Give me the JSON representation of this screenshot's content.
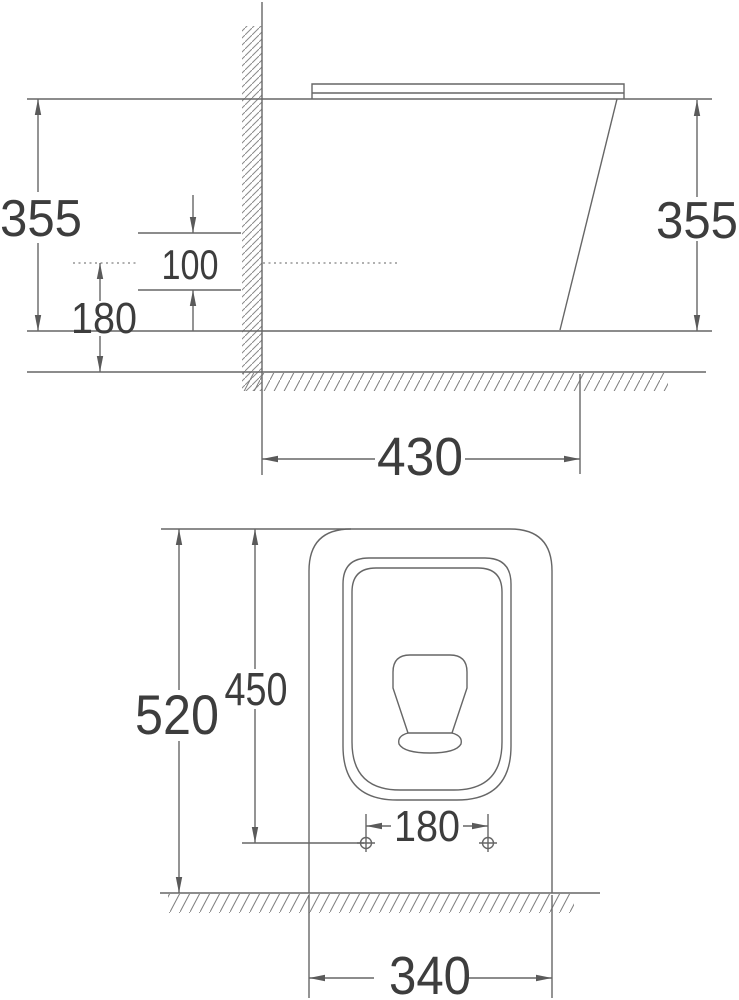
{
  "colors": {
    "background": "#ffffff",
    "line": "#666666",
    "hatch": "#8a8a8a",
    "text": "#3d3d3d"
  },
  "side_view": {
    "description": "side elevation of wall-adjacent toilet with wall and floor hatching",
    "labels": {
      "height_left": "355",
      "outlet_offset": "100",
      "outlet_height": "180",
      "height_right": "355",
      "depth_from_wall": "430"
    }
  },
  "plan_view": {
    "description": "top plan view of toilet with seat ring, bowl sump and fixing holes",
    "labels": {
      "total_depth": "520",
      "holes_to_front": "450",
      "hole_spacing": "180",
      "width_at_wall": "340"
    }
  }
}
